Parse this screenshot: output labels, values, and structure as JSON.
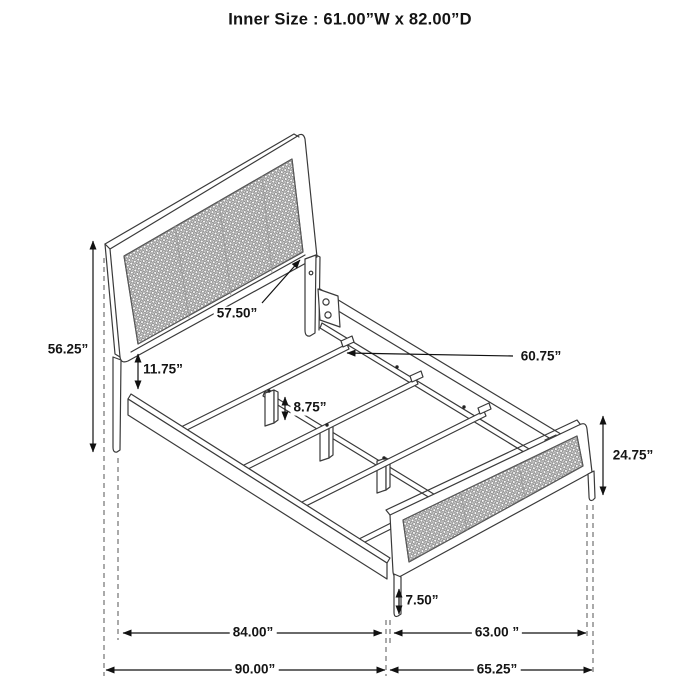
{
  "title": "Inner Size : 61.00”W x 82.00”D",
  "labels": {
    "headboard_total_height": "56.25”",
    "headboard_panel_width": "57.50”",
    "rail_clearance_height": "11.75”",
    "slat_length": "60.75”",
    "center_leg_height": "8.75”",
    "footboard_height": "24.75”",
    "footboard_clearance": "7.50”",
    "side_rail_span": "84.00”",
    "footboard_width": "63.00 ”",
    "overall_depth": "90.00”",
    "footboard_overall_width": "65.25”"
  },
  "colors": {
    "line": "#3a3a3a",
    "dimension": "#111111",
    "mesh": "#787878"
  }
}
